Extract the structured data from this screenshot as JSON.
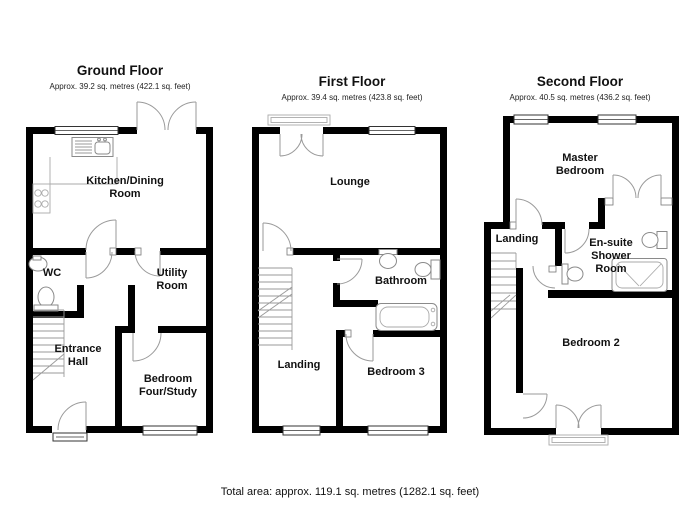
{
  "floors": [
    {
      "title": "Ground Floor",
      "subtitle": "Approx. 39.2 sq. metres (422.1 sq. feet)",
      "rooms": {
        "kitchen_l1": "Kitchen/Dining",
        "kitchen_l2": "Room",
        "wc": "WC",
        "utility_l1": "Utility",
        "utility_l2": "Room",
        "hall_l1": "Entrance",
        "hall_l2": "Hall",
        "bed4_l1": "Bedroom",
        "bed4_l2": "Four/Study"
      }
    },
    {
      "title": "First Floor",
      "subtitle": "Approx. 39.4 sq. metres (423.8 sq. feet)",
      "rooms": {
        "lounge": "Lounge",
        "bathroom": "Bathroom",
        "landing": "Landing",
        "bed3": "Bedroom 3"
      }
    },
    {
      "title": "Second Floor",
      "subtitle": "Approx. 40.5 sq. metres (436.2 sq. feet)",
      "rooms": {
        "master_l1": "Master",
        "master_l2": "Bedroom",
        "landing": "Landing",
        "ensuite_l1": "En-suite",
        "ensuite_l2": "Shower",
        "ensuite_l3": "Room",
        "bed2": "Bedroom 2"
      }
    }
  ],
  "footer": {
    "total_area": "Total area: approx. 119.1 sq. metres (1282.1 sq. feet)"
  },
  "colors": {
    "wall": "#000000",
    "fixture": "#8a8a8a",
    "text": "#111111",
    "background": "#ffffff"
  }
}
